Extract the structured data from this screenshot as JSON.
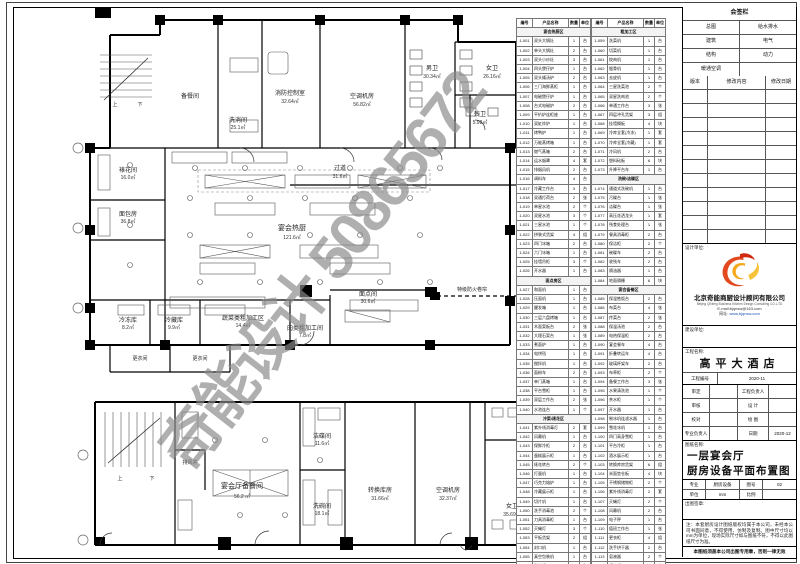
{
  "watermark": "奇能设计 50865672",
  "signature_panel": {
    "title": "会签栏",
    "disciplines": [
      [
        "总图",
        "给水排水"
      ],
      [
        "建筑",
        "电气"
      ],
      [
        "结构",
        "动力"
      ],
      [
        "暖通空调",
        ""
      ]
    ],
    "revision_headers": [
      "版本",
      "修改内容",
      "修改日期"
    ]
  },
  "design_firm": {
    "label": "设计单位:",
    "name_cn": "北京奇能商厨设计顾问有限公司",
    "name_en": "Beijing QiNeng Business Kitchen Design Consulting CO.,LTD",
    "email": "E-mail:bjqnsw@163.com",
    "website_label": "网址:",
    "website": "www.bjqnsw.com"
  },
  "owner": {
    "label": "建设单位:"
  },
  "project": {
    "label": "工程名称:",
    "name": "高平大酒店",
    "no_label": "工程编号",
    "no": "2020-11"
  },
  "signoff": {
    "rows": [
      [
        "审定",
        "",
        "工程负责人",
        ""
      ],
      [
        "审核",
        "",
        "设 计",
        ""
      ],
      [
        "校对",
        "",
        "绘 图",
        ""
      ],
      [
        "专业负责人",
        "",
        "日期",
        "2020-12"
      ]
    ]
  },
  "sheet_info": {
    "label": "图纸名称:",
    "title1": "一层宴会厅",
    "title2": "厨房设备平面布置图",
    "spec": [
      [
        "专业",
        "厨房设备",
        "图号",
        "02"
      ],
      [
        "单位",
        "mm",
        "比例",
        ""
      ]
    ],
    "stamp_label": "出图签章:",
    "notes": "注：本套厨房设计图纸版权均属于本公司，未经本公司书面同意，不得使用、仿制及复制。图中尺寸均以mm为单位，现场实际尺寸如与图纸不符，不得以此图纸尺寸为准。",
    "footer": "本图纸须盖本公司出图专用章，否则一律无效"
  },
  "equipment_tables": {
    "headers": [
      "编号",
      "产品名称",
      "数量",
      "单位"
    ],
    "table1": [
      {
        "s": "宴会热厨区"
      },
      [
        "1-001",
        "双头大锅灶",
        "1",
        "台"
      ],
      [
        "1-002",
        "单头大锅灶",
        "2",
        "台"
      ],
      [
        "1-003",
        "双头小炒灶",
        "3",
        "台"
      ],
      [
        "1-004",
        "四头煲仔炉",
        "1",
        "台"
      ],
      [
        "1-005",
        "双头矮汤炉",
        "2",
        "台"
      ],
      [
        "1-006",
        "三门海鲜蒸柜",
        "1",
        "台"
      ],
      [
        "1-007",
        "电磁煲仔炉",
        "1",
        "台"
      ],
      [
        "1-008",
        "台式电磁炉",
        "2",
        "台"
      ],
      [
        "1-009",
        "平扒炉连柜座",
        "1",
        "台"
      ],
      [
        "1-010",
        "双缸炸炉",
        "1",
        "台"
      ],
      [
        "1-011",
        "烤鸭炉",
        "1",
        "台"
      ],
      [
        "1-012",
        "万能蒸烤箱",
        "1",
        "台"
      ],
      [
        "1-013",
        "燃气蒸箱",
        "2",
        "台"
      ],
      [
        "1-014",
        "运水烟罩",
        "4",
        "套"
      ],
      [
        "1-015",
        "排烟风机",
        "2",
        "台"
      ],
      [
        "1-016",
        "调料车",
        "4",
        "台"
      ],
      [
        "1-017",
        "冷藏工作台",
        "3",
        "台"
      ],
      [
        "1-018",
        "双通打荷台",
        "2",
        "张"
      ],
      [
        "1-019",
        "单星水池",
        "2",
        "个"
      ],
      [
        "1-020",
        "双星水池",
        "3",
        "个"
      ],
      [
        "1-021",
        "三星水池",
        "1",
        "个"
      ],
      [
        "1-022",
        "拼装式货架",
        "4",
        "组"
      ],
      [
        "1-023",
        "四门冰箱",
        "2",
        "台"
      ],
      [
        "1-024",
        "六门冰箱",
        "1",
        "台"
      ],
      [
        "1-025",
        "挂墙吊柜",
        "3",
        "个"
      ],
      [
        "1-026",
        "开水器",
        "1",
        "台"
      ],
      {
        "s": "面点房区"
      },
      [
        "1-027",
        "和面机",
        "1",
        "台"
      ],
      [
        "1-028",
        "压面机",
        "1",
        "台"
      ],
      [
        "1-029",
        "醒发箱",
        "1",
        "台"
      ],
      [
        "1-030",
        "三层六盘烤箱",
        "1",
        "台"
      ],
      [
        "1-031",
        "木面案板台",
        "2",
        "张"
      ],
      [
        "1-032",
        "大理石案台",
        "1",
        "张"
      ],
      [
        "1-033",
        "煮面炉",
        "1",
        "台"
      ],
      [
        "1-034",
        "电饼铛",
        "1",
        "台"
      ],
      [
        "1-035",
        "搅拌机",
        "1",
        "台"
      ],
      [
        "1-036",
        "面粉车",
        "2",
        "台"
      ],
      [
        "1-037",
        "单门蒸箱",
        "1",
        "台"
      ],
      [
        "1-038",
        "平台雪柜",
        "1",
        "台"
      ],
      [
        "1-039",
        "双层工作台",
        "2",
        "张"
      ],
      [
        "1-040",
        "水池连台",
        "1",
        "个"
      ],
      {
        "s": "冷菜/裱花区"
      },
      [
        "1-041",
        "紫外线消毒灯",
        "2",
        "套"
      ],
      [
        "1-042",
        "风幕机",
        "1",
        "台"
      ],
      [
        "1-043",
        "保鲜冷柜",
        "2",
        "台"
      ],
      [
        "1-044",
        "蛋糕展示柜",
        "1",
        "台"
      ],
      [
        "1-045",
        "裱花转台",
        "2",
        "个"
      ],
      [
        "1-046",
        "打蛋机",
        "1",
        "台"
      ],
      [
        "1-047",
        "巧克力熔炉",
        "1",
        "台"
      ],
      [
        "1-048",
        "冷藏展示柜",
        "1",
        "台"
      ],
      [
        "1-049",
        "切片机",
        "1",
        "台"
      ],
      [
        "1-050",
        "洗手消毒池",
        "2",
        "个"
      ],
      [
        "1-051",
        "刀具消毒柜",
        "1",
        "台"
      ],
      [
        "1-052",
        "灭蝇灯",
        "3",
        "个"
      ],
      [
        "1-053",
        "平板货架",
        "2",
        "组"
      ],
      [
        "1-054",
        "封口机",
        "1",
        "台"
      ],
      [
        "1-055",
        "真空包装机",
        "1",
        "台"
      ],
      [
        "1-056",
        "制冰机",
        "1",
        "台"
      ],
      [
        "1-057",
        "果汁机",
        "2",
        "台"
      ],
      [
        "1-058",
        "咖啡机",
        "1",
        "台"
      ]
    ],
    "table2": [
      {
        "s": "粗加工区"
      },
      [
        "1-059",
        "洗菜机",
        "1",
        "台"
      ],
      [
        "1-060",
        "切菜机",
        "1",
        "台"
      ],
      [
        "1-061",
        "绞肉机",
        "1",
        "台"
      ],
      [
        "1-062",
        "锯骨机",
        "1",
        "台"
      ],
      [
        "1-063",
        "去皮机",
        "1",
        "台"
      ],
      [
        "1-064",
        "三星洗菜池",
        "2",
        "个"
      ],
      [
        "1-065",
        "双星洗肉池",
        "2",
        "个"
      ],
      [
        "1-066",
        "单通工作台",
        "3",
        "张"
      ],
      [
        "1-067",
        "四层冲孔货架",
        "3",
        "组"
      ],
      [
        "1-068",
        "挂墙搁板",
        "4",
        "块"
      ],
      [
        "1-069",
        "冷库全套(冷冻)",
        "1",
        "套"
      ],
      [
        "1-070",
        "冷库全套(冷藏)",
        "1",
        "套"
      ],
      [
        "1-071",
        "冷风机",
        "2",
        "台"
      ],
      [
        "1-072",
        "塑料砧板",
        "6",
        "块"
      ],
      [
        "1-073",
        "升降平台车",
        "1",
        "台"
      ],
      {
        "s": "洗碗/洁碟区"
      },
      [
        "1-074",
        "通道式洗碗机",
        "1",
        "台"
      ],
      [
        "1-075",
        "污碟台",
        "1",
        "张"
      ],
      [
        "1-076",
        "洁碟台",
        "1",
        "张"
      ],
      [
        "1-077",
        "高压花洒龙头",
        "1",
        "套"
      ],
      [
        "1-078",
        "残食处理台",
        "1",
        "张"
      ],
      [
        "1-079",
        "餐具消毒柜",
        "2",
        "台"
      ],
      [
        "1-080",
        "保洁柜",
        "2",
        "个"
      ],
      [
        "1-081",
        "碗碟车",
        "2",
        "台"
      ],
      [
        "1-082",
        "收残车",
        "2",
        "台"
      ],
      [
        "1-083",
        "隔油器",
        "1",
        "台"
      ],
      [
        "1-084",
        "地面隔栅",
        "6",
        "块"
      ],
      {
        "s": "宴会备餐区"
      },
      [
        "1-085",
        "保温售饭台",
        "2",
        "台"
      ],
      [
        "1-086",
        "布菜台",
        "4",
        "张"
      ],
      [
        "1-087",
        "传菜台",
        "2",
        "张"
      ],
      [
        "1-088",
        "保温汤池",
        "2",
        "台"
      ],
      [
        "1-089",
        "电热保温柜",
        "2",
        "台"
      ],
      [
        "1-090",
        "宴会餐车",
        "4",
        "台"
      ],
      [
        "1-091",
        "折叠转运车",
        "4",
        "台"
      ],
      [
        "1-092",
        "玻璃杯架车",
        "2",
        "台"
      ],
      [
        "1-093",
        "布草柜",
        "2",
        "个"
      ],
      [
        "1-094",
        "备餐工作台",
        "3",
        "张"
      ],
      [
        "1-095",
        "水果清洗池",
        "1",
        "个"
      ],
      [
        "1-096",
        "茶水柜",
        "1",
        "个"
      ],
      [
        "1-097",
        "开水器",
        "1",
        "台"
      ],
      [
        "1-098",
        "制冰机连滤水器",
        "1",
        "台"
      ],
      [
        "1-099",
        "雪花冰机",
        "1",
        "台"
      ],
      [
        "1-100",
        "四门高身雪柜",
        "1",
        "台"
      ],
      [
        "1-101",
        "平台冷柜",
        "1",
        "台"
      ],
      [
        "1-102",
        "酒水展示柜",
        "1",
        "台"
      ],
      [
        "1-103",
        "转换库房货架",
        "6",
        "组"
      ],
      [
        "1-104",
        "米面垫仓板",
        "4",
        "块"
      ],
      [
        "1-105",
        "不锈钢储物柜",
        "2",
        "个"
      ],
      [
        "1-106",
        "紫外线消毒灯",
        "2",
        "套"
      ],
      [
        "1-107",
        "灭蝇灯",
        "2",
        "个"
      ],
      [
        "1-108",
        "风幕机",
        "2",
        "台"
      ],
      [
        "1-109",
        "电子秤",
        "1",
        "台"
      ],
      [
        "1-110",
        "值班工作台",
        "1",
        "张"
      ],
      [
        "1-111",
        "更衣柜",
        "4",
        "组"
      ],
      [
        "1-112",
        "洗手烘干器",
        "2",
        "台"
      ],
      [
        "1-113",
        "皂液器",
        "2",
        "个"
      ],
      [
        "1-114",
        "纸巾架",
        "2",
        "个"
      ]
    ]
  },
  "plan_upper": {
    "rooms": [
      {
        "name": "备餐间",
        "area": ""
      },
      {
        "name": "洗消间",
        "area": "25.1㎡"
      },
      {
        "name": "消防控制室",
        "area": "32.64㎡"
      },
      {
        "name": "空调机房",
        "area": "56.82㎡"
      },
      {
        "name": "男卫",
        "area": "30.34㎡"
      },
      {
        "name": "女卫",
        "area": "26.16㎡"
      },
      {
        "name": "残卫",
        "area": "5.98㎡"
      },
      {
        "name": "过道",
        "area": "31.6㎡"
      },
      {
        "name": "裱花间",
        "area": "16.0㎡"
      },
      {
        "name": "面包房",
        "area": "36.8㎡"
      },
      {
        "name": "宴会热厨",
        "area": "121.6㎡"
      },
      {
        "name": "面点间",
        "area": "30.6㎡"
      },
      {
        "name": "冷冻库",
        "area": "8.2㎡"
      },
      {
        "name": "冷藏库",
        "area": "9.9㎡"
      },
      {
        "name": "蔬菜类粗加工区",
        "area": "14.4㎡"
      },
      {
        "name": "肉类粗加工间",
        "area": "7.8㎡"
      },
      {
        "name": "更衣间",
        "area": "7.9㎡"
      },
      {
        "name": "更衣间",
        "area": "7.9㎡"
      }
    ],
    "up": "上",
    "down": "下",
    "shutter": "特级防火卷帘"
  },
  "plan_lower": {
    "rooms": [
      {
        "name": "宴会厅备餐间",
        "area": "56.2 ㎡"
      },
      {
        "name": "洁碟间",
        "area": "11.6㎡"
      },
      {
        "name": "洗碗间",
        "area": "18.1㎡"
      },
      {
        "name": "转换库房",
        "area": "31.66㎡"
      },
      {
        "name": "空调机房",
        "area": "32.37㎡"
      },
      {
        "name": "女卫",
        "area": "35.69㎡"
      }
    ],
    "up": "上",
    "down": "下",
    "vent": "排风井"
  }
}
